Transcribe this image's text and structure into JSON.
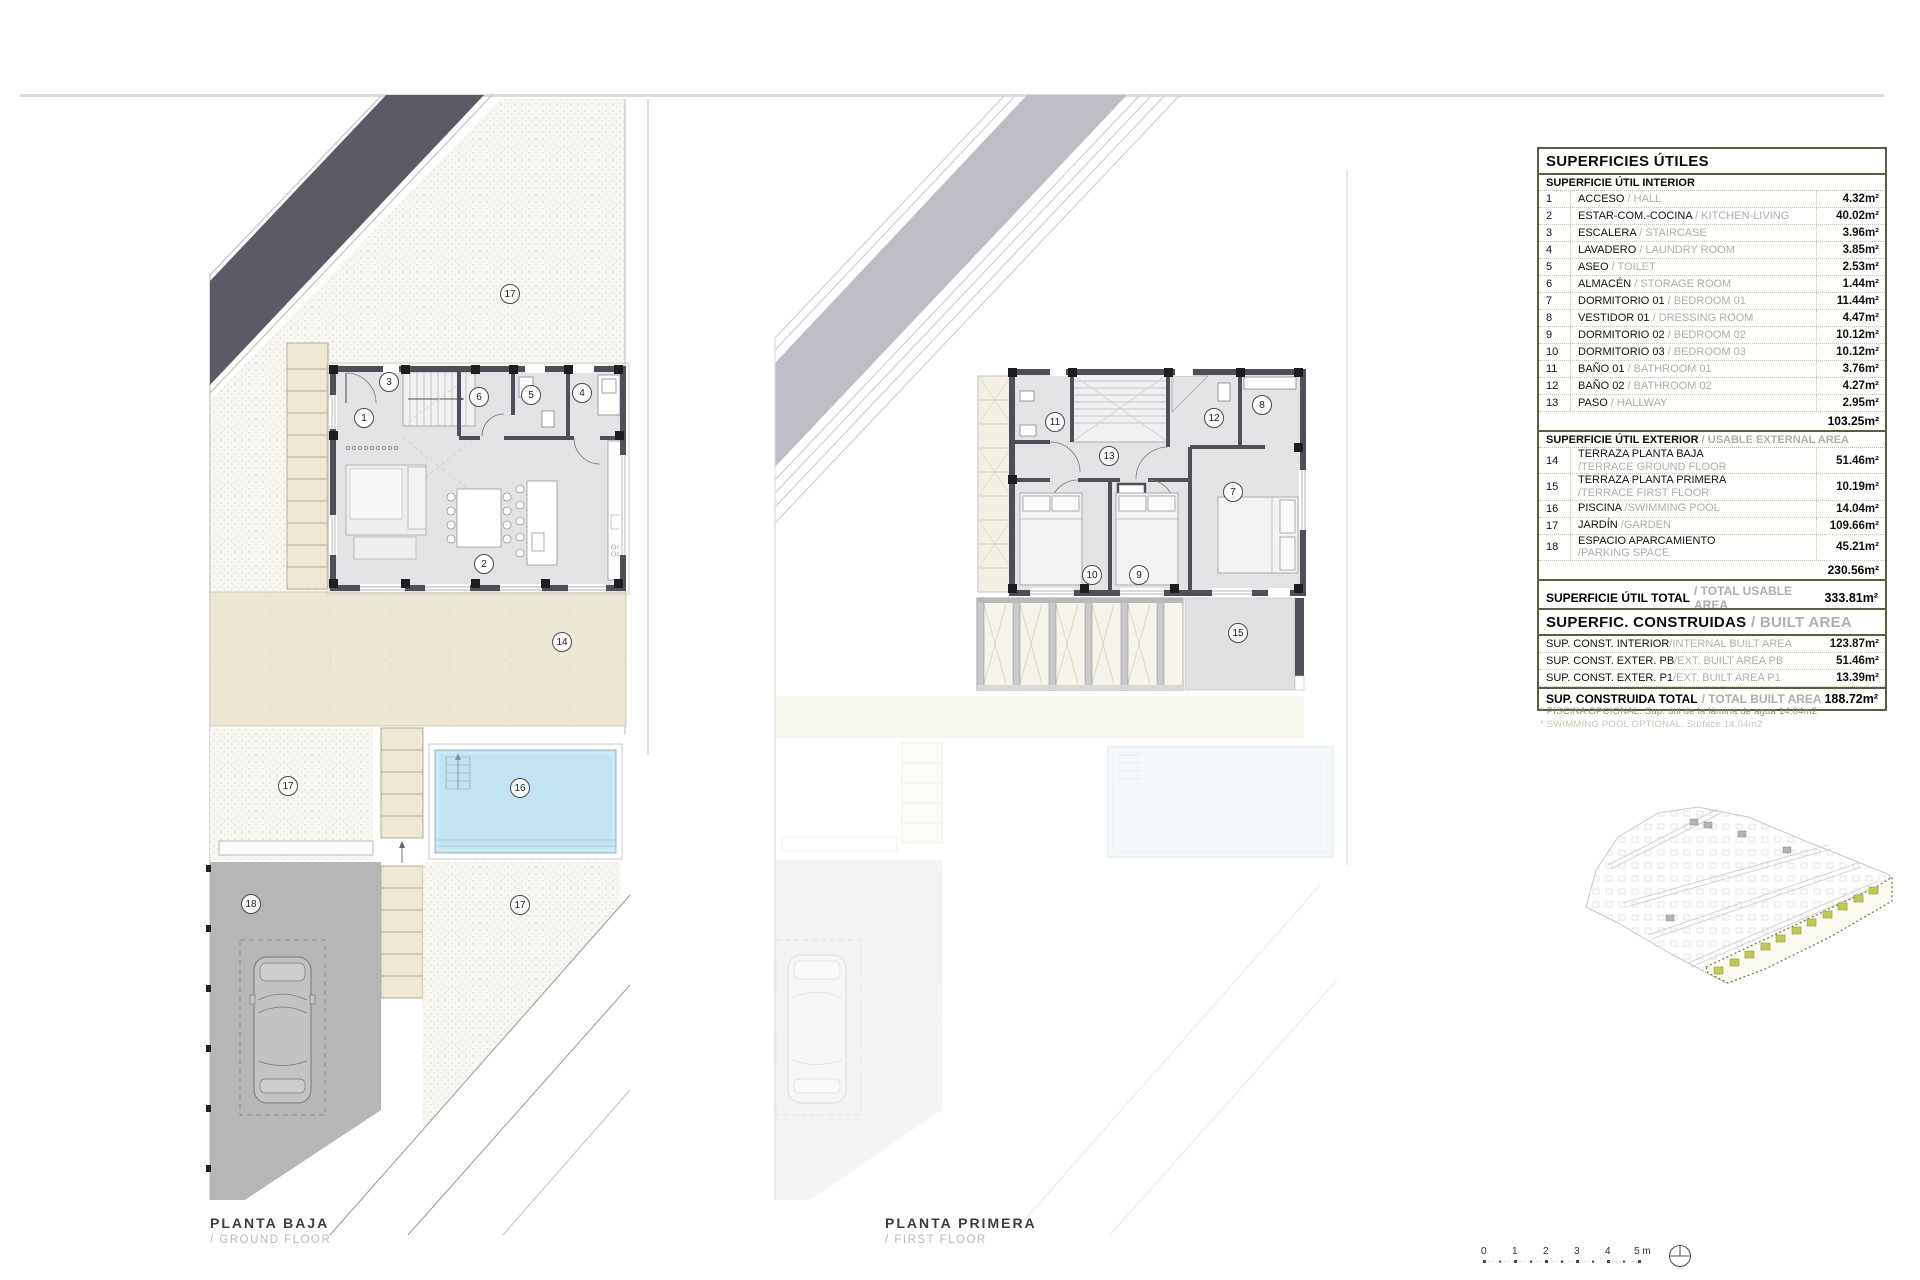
{
  "plans": {
    "ground": {
      "title": "PLANTA BAJA",
      "subtitle": "/ GROUND FLOOR",
      "rooms": [
        "17",
        "1",
        "3",
        "6",
        "5",
        "4",
        "2",
        "14",
        "17",
        "16",
        "17",
        "18"
      ]
    },
    "first": {
      "title": "PLANTA PRIMERA",
      "subtitle": "/ FIRST FLOOR",
      "rooms": [
        "11",
        "12",
        "8",
        "13",
        "7",
        "10",
        "9",
        "15"
      ]
    }
  },
  "tables": {
    "usable": {
      "title": "SUPERFICIES ÚTILES",
      "interior_header": "SUPERFICIE ÚTIL INTERIOR",
      "interior_rows": [
        {
          "num": "1",
          "es": "ACCESO",
          "en": " / HALL",
          "value": "4.32m²"
        },
        {
          "num": "2",
          "es": "ESTAR-COM.-COCINA",
          "en": " / KITCHEN-LIVING",
          "value": "40.02m²"
        },
        {
          "num": "3",
          "es": "ESCALERA",
          "en": " / STAIRCASE",
          "value": "3.96m²"
        },
        {
          "num": "4",
          "es": "LAVADERO",
          "en": " / LAUNDRY ROOM",
          "value": "3.85m²"
        },
        {
          "num": "5",
          "es": "ASEO",
          "en": " / TOILET",
          "value": "2.53m²"
        },
        {
          "num": "6",
          "es": "ALMACÉN",
          "en": " / STORAGE ROOM",
          "value": "1.44m²"
        },
        {
          "num": "7",
          "es": "DORMITORIO 01",
          "en": " / BEDROOM 01",
          "value": "11.44m²"
        },
        {
          "num": "8",
          "es": "VESTIDOR 01",
          "en": " / DRESSING ROOM",
          "value": "4.47m²"
        },
        {
          "num": "9",
          "es": "DORMITORIO 02",
          "en": " / BEDROOM 02",
          "value": "10.12m²"
        },
        {
          "num": "10",
          "es": "DORMITORIO 03",
          "en": " / BEDROOM 03",
          "value": "10.12m²"
        },
        {
          "num": "11",
          "es": "BAÑO 01",
          "en": " / BATHROOM 01",
          "value": "3.76m²"
        },
        {
          "num": "12",
          "es": "BAÑO 02",
          "en": " / BATHROOM 02",
          "value": "4.27m²"
        },
        {
          "num": "13",
          "es": "PASO",
          "en": " / HALLWAY",
          "value": "2.95m²"
        }
      ],
      "interior_subtotal": "103.25m²",
      "exterior_header_es": "SUPERFICIE ÚTIL EXTERIOR",
      "exterior_header_en": " / USABLE EXTERNAL AREA",
      "exterior_rows": [
        {
          "num": "14",
          "es": "TERRAZA PLANTA BAJA",
          "en2": "/TERRACE GROUND FLOOR",
          "value": "51.46m²"
        },
        {
          "num": "15",
          "es": "TERRAZA PLANTA PRIMERA",
          "en2": "/TERRACE FIRST FLOOR",
          "value": "10.19m²"
        },
        {
          "num": "16",
          "es": "PISCINA",
          "en": " /SWIMMING POOL",
          "value": "14.04m²"
        },
        {
          "num": "17",
          "es": "JARDÍN",
          "en": " /GARDEN",
          "value": "109.66m²"
        },
        {
          "num": "18",
          "es": "ESPACIO APARCAMIENTO",
          "en2": "/PARKING SPACE",
          "value": "45.21m²"
        }
      ],
      "exterior_subtotal": "230.56m²",
      "total_es": "SUPERFICIE ÚTIL TOTAL",
      "total_en": "/ TOTAL USABLE AREA",
      "total_value": "333.81m²"
    },
    "built": {
      "title_es": "SUPERFIC. CONSTRUIDAS",
      "title_en": " / BUILT AREA",
      "rows": [
        {
          "es": "SUP. CONST. INTERIOR",
          "en": "/INTERNAL BUILT AREA",
          "value": "123.87m²"
        },
        {
          "es": "SUP. CONST. EXTER. PB",
          "en": "/EXT. BUILT AREA PB",
          "value": "51.46m²"
        },
        {
          "es": "SUP. CONST. EXTER. P1",
          "en": "/EXT. BUILT AREA P1",
          "value": "13.39m²"
        }
      ],
      "total_es": "SUP. CONSTRUIDA TOTAL",
      "total_en": "/ TOTAL BUILT AREA",
      "total_value": "188.72m²",
      "footnote1": "* PISCINA OPCIONAL. Sup. útil de la lámina de agua 14.04m2",
      "footnote2": "* SWIMMING POOL OPTIONAL. Surface 14.04m2"
    }
  },
  "scalebar": {
    "t0": "0",
    "t1": "1",
    "t2": "2",
    "t3": "3",
    "t4": "4",
    "t5": "5 m"
  },
  "colors": {
    "wall": "#514e5a",
    "band_dark": "#5d5a66",
    "band_light": "#bdbdc5",
    "floor": "#e3e3e5",
    "beige": "#ebe7d2",
    "pool": "#c4e3f0",
    "parking": "#b6b6b6",
    "table_border": "#5c5c40",
    "site_green": "#c3cb4e"
  }
}
